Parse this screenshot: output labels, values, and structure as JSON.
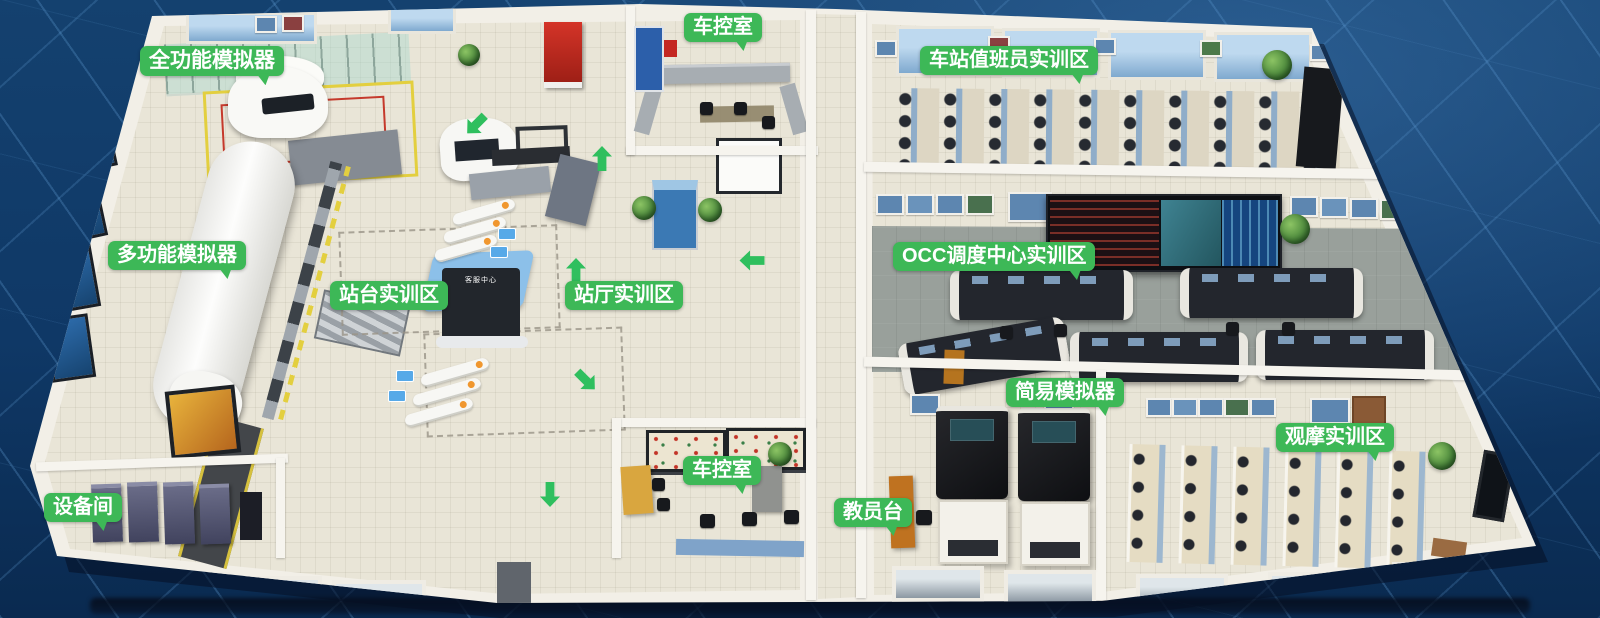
{
  "labels": [
    {
      "id": "full-function-simulator",
      "text": "全功能模拟器"
    },
    {
      "id": "vehicle-control-room-top",
      "text": "车控室"
    },
    {
      "id": "station-attendant-training-area",
      "text": "车站值班员实训区"
    },
    {
      "id": "multi-function-simulator",
      "text": "多功能模拟器"
    },
    {
      "id": "platform-training-area",
      "text": "站台实训区"
    },
    {
      "id": "station-hall-training-area",
      "text": "站厅实训区"
    },
    {
      "id": "occ-dispatch-center-training-area",
      "text": "OCC调度中心实训区"
    },
    {
      "id": "simple-simulator",
      "text": "简易模拟器"
    },
    {
      "id": "instructor-station",
      "text": "教员台"
    },
    {
      "id": "equipment-room",
      "text": "设备间"
    },
    {
      "id": "vehicle-control-room-bottom",
      "text": "车控室"
    },
    {
      "id": "observation-training-area",
      "text": "观摩实训区"
    }
  ],
  "kiosk": {
    "text": "客服中心"
  },
  "colors": {
    "background": "#0f3866",
    "grid_line": "#609cd2",
    "label_bg": "#3db857",
    "label_text": "#ffffff",
    "wall": "#f2efe7",
    "floor": "#e9e5d7",
    "occ_floor": "#99a09b",
    "floor_arrow_green": "#2fbf5e",
    "train_white": "#f9f9f6",
    "video_wall": "#0d0f13",
    "instructor_desk_orange": "#bf7220",
    "window_blue": "#bed9ef"
  }
}
